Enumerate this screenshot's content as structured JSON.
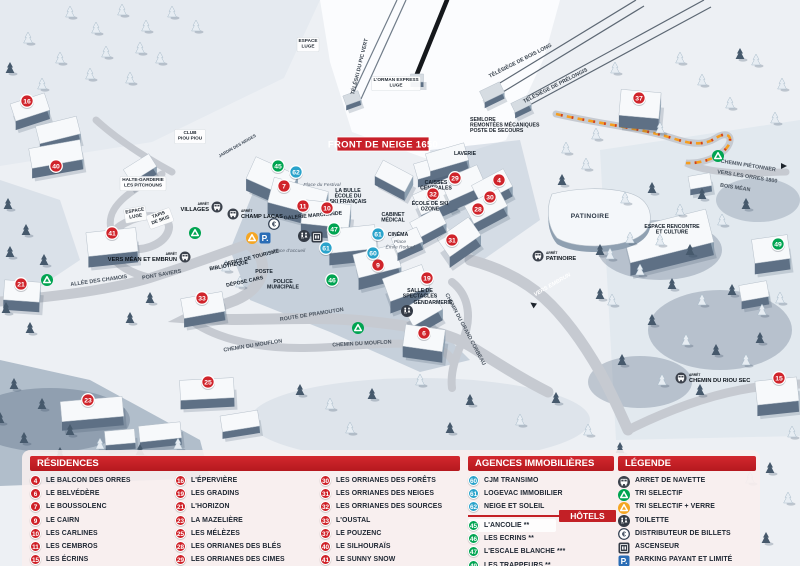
{
  "map": {
    "banner": "FRONT DE NEIGE 1650",
    "arret_word": "ARRÊT",
    "marker_colors": {
      "residence": "#d0242b",
      "hotel": "#00a451",
      "agency": "#2aa3cb"
    },
    "markers": [
      {
        "num": "16",
        "type": "residence",
        "x": 27,
        "y": 101
      },
      {
        "num": "40",
        "type": "residence",
        "x": 56,
        "y": 166
      },
      {
        "num": "41",
        "type": "residence",
        "x": 112,
        "y": 233
      },
      {
        "num": "21",
        "type": "residence",
        "x": 21,
        "y": 284
      },
      {
        "num": "33",
        "type": "residence",
        "x": 202,
        "y": 298
      },
      {
        "num": "23",
        "type": "residence",
        "x": 88,
        "y": 400
      },
      {
        "num": "25",
        "type": "residence",
        "x": 208,
        "y": 382
      },
      {
        "num": "7",
        "type": "residence",
        "x": 284,
        "y": 186
      },
      {
        "num": "11",
        "type": "residence",
        "x": 303,
        "y": 206
      },
      {
        "num": "10",
        "type": "residence",
        "x": 327,
        "y": 208
      },
      {
        "num": "9",
        "type": "residence",
        "x": 378,
        "y": 265
      },
      {
        "num": "19",
        "type": "residence",
        "x": 427,
        "y": 278
      },
      {
        "num": "6",
        "type": "residence",
        "x": 424,
        "y": 333
      },
      {
        "num": "32",
        "type": "residence",
        "x": 433,
        "y": 194
      },
      {
        "num": "29",
        "type": "residence",
        "x": 455,
        "y": 178
      },
      {
        "num": "4",
        "type": "residence",
        "x": 499,
        "y": 180
      },
      {
        "num": "30",
        "type": "residence",
        "x": 490,
        "y": 197
      },
      {
        "num": "28",
        "type": "residence",
        "x": 478,
        "y": 209
      },
      {
        "num": "31",
        "type": "residence",
        "x": 452,
        "y": 240
      },
      {
        "num": "37",
        "type": "residence",
        "x": 639,
        "y": 98
      },
      {
        "num": "15",
        "type": "residence",
        "x": 779,
        "y": 378
      },
      {
        "num": "45",
        "type": "hotel",
        "x": 278,
        "y": 166
      },
      {
        "num": "47",
        "type": "hotel",
        "x": 334,
        "y": 229
      },
      {
        "num": "46",
        "type": "hotel",
        "x": 332,
        "y": 280
      },
      {
        "num": "49",
        "type": "hotel",
        "x": 778,
        "y": 244
      },
      {
        "num": "62",
        "type": "agency",
        "x": 296,
        "y": 172
      },
      {
        "num": "61",
        "type": "agency",
        "x": 326,
        "y": 248
      },
      {
        "num": "61",
        "type": "agency",
        "x": 378,
        "y": 234
      },
      {
        "num": "60",
        "type": "agency",
        "x": 373,
        "y": 253
      }
    ],
    "labels": [
      {
        "text": "CLUB\nPIOU PIOU",
        "x": 190,
        "y": 134,
        "rot": 0,
        "cls": "wbox"
      },
      {
        "text": "ESPACE\nLUGE",
        "x": 308,
        "y": 42,
        "rot": 0,
        "cls": "wbox"
      },
      {
        "text": "L'ORMAN EXPRESS\nLUGE",
        "x": 396,
        "y": 81,
        "rot": 0,
        "cls": "wbox"
      },
      {
        "text": "HALTE-GARDERIE\nLES PITCHOUNS",
        "x": 143,
        "y": 181,
        "rot": 0,
        "cls": "wbox"
      },
      {
        "text": "ESPACE\nLUGE",
        "x": 135,
        "y": 212,
        "rot": -10,
        "cls": "wbox"
      },
      {
        "text": "TAPIS\nDE SKIS",
        "x": 159,
        "y": 216,
        "rot": -20,
        "cls": "wbox"
      },
      {
        "text": "JARDIN DES NEIGES",
        "x": 238,
        "y": 147,
        "rot": -30,
        "cls": "tiny"
      },
      {
        "text": "TÉLÉSKI DU PIC VERT",
        "x": 361,
        "y": 67,
        "rot": -76,
        "cls": "lift"
      },
      {
        "text": "TÉLÉSIÈGE DE BOIS LONG",
        "x": 521,
        "y": 62,
        "rot": -27,
        "cls": "lift"
      },
      {
        "text": "TÉLÉSIÈGE DE PRÉLONGIS",
        "x": 556,
        "y": 87,
        "rot": -27,
        "cls": "lift"
      },
      {
        "text": "SEMLORE\nREMONTÉES MÉCANIQUES\nPOSTE DE SECOURS",
        "x": 470,
        "y": 121,
        "rot": 0,
        "cls": "plainL"
      },
      {
        "text": "ALLÉE DES CHAMOIS",
        "x": 99,
        "y": 282,
        "rot": -8,
        "cls": "road"
      },
      {
        "text": "PONT SAVIERS",
        "x": 162,
        "y": 276,
        "rot": -10,
        "cls": "road"
      },
      {
        "text": "ROUTE DE PRAMOUTON",
        "x": 312,
        "y": 316,
        "rot": -9,
        "cls": "road"
      },
      {
        "text": "CHEMIN DU MOUFLON",
        "x": 253,
        "y": 347,
        "rot": -9,
        "cls": "road"
      },
      {
        "text": "CHEMIN DU MOUFLON",
        "x": 362,
        "y": 345,
        "rot": -3,
        "cls": "road"
      },
      {
        "text": "CHEMIN DU GRAND CORBEAU",
        "x": 464,
        "y": 330,
        "rot": 62,
        "cls": "road"
      },
      {
        "text": "VERS EMBRUN",
        "x": 553,
        "y": 286,
        "rot": -30,
        "cls": "roadlight"
      },
      {
        "text": "CHEMIN PIÉTONNIER",
        "x": 748,
        "y": 167,
        "rot": 9,
        "cls": "road"
      },
      {
        "text": "VERS LES ORRES 1800",
        "x": 747,
        "y": 178,
        "rot": 9,
        "cls": "road"
      },
      {
        "text": "BOIS MÉAN",
        "x": 735,
        "y": 189,
        "rot": 9,
        "cls": "road"
      },
      {
        "text": "OFFICE DE TOURISME",
        "x": 252,
        "y": 259,
        "rot": -14,
        "cls": "facility"
      },
      {
        "text": "BIBLIOTHÈQUE",
        "x": 229,
        "y": 267,
        "rot": -10,
        "cls": "facility"
      },
      {
        "text": "POSTE",
        "x": 264,
        "y": 273,
        "rot": 0,
        "cls": "facility"
      },
      {
        "text": "DÉPOSE CARS",
        "x": 245,
        "y": 283,
        "rot": -12,
        "cls": "facility"
      },
      {
        "text": "POLICE\nMUNICIPALE",
        "x": 283,
        "y": 283,
        "rot": 0,
        "cls": "facility"
      },
      {
        "text": "GALERIE MARCHANDE",
        "x": 313,
        "y": 217,
        "rot": -5,
        "cls": "facility"
      },
      {
        "text": "LA BULLE\nÉCOLE DU\nSKI FRANÇAIS",
        "x": 348,
        "y": 192,
        "rot": 0,
        "cls": "facility"
      },
      {
        "text": "CAISSES\nCENTRALES",
        "x": 436,
        "y": 184,
        "rot": 0,
        "cls": "facility"
      },
      {
        "text": "LAVERIE",
        "x": 465,
        "y": 155,
        "rot": 0,
        "cls": "facility"
      },
      {
        "text": "ÉCOLE DE SKI\nOZONE",
        "x": 430,
        "y": 205,
        "rot": 0,
        "cls": "facility"
      },
      {
        "text": "CABINET\nMÉDICAL",
        "x": 393,
        "y": 216,
        "rot": 0,
        "cls": "facility"
      },
      {
        "text": "CINÉMA",
        "x": 398,
        "y": 236,
        "rot": 0,
        "cls": "facility"
      },
      {
        "text": "SALLE DE\nSPECTACLES",
        "x": 420,
        "y": 292,
        "rot": 0,
        "cls": "facility"
      },
      {
        "text": "GENDARMERIE",
        "x": 433,
        "y": 304,
        "rot": 0,
        "cls": "facility"
      },
      {
        "text": "PATINOIRE",
        "x": 590,
        "y": 218,
        "rot": 0,
        "cls": "facility-lg"
      },
      {
        "text": "ESPACE RENCONTRE\nET CULTURE",
        "x": 672,
        "y": 228,
        "rot": 0,
        "cls": "facility"
      },
      {
        "text": "Place du Festival",
        "x": 322,
        "y": 186,
        "rot": 0,
        "cls": "pit"
      },
      {
        "text": "Place d'accueil",
        "x": 289,
        "y": 252,
        "rot": 0,
        "cls": "pit"
      },
      {
        "text": "Place\nÉmile Rodoul",
        "x": 400,
        "y": 243,
        "rot": 0,
        "cls": "pit"
      }
    ],
    "bus_stops": [
      {
        "name": "VILLAGES",
        "tx": 209,
        "ty": 211,
        "anchor": "end",
        "ix": 217,
        "iy": 207
      },
      {
        "name": "CHAMP LACAS",
        "tx": 241,
        "ty": 218,
        "anchor": "start",
        "ix": 233,
        "iy": 214
      },
      {
        "name": "VERS MÉAN ET EMBRUN",
        "tx": 177,
        "ty": 261,
        "anchor": "end",
        "ix": 185,
        "iy": 257
      },
      {
        "name": "PATINOIRE",
        "tx": 546,
        "ty": 260,
        "anchor": "start",
        "ix": 538,
        "iy": 256
      },
      {
        "name": "CHEMIN DU RIOU SEC",
        "tx": 689,
        "ty": 382,
        "anchor": "start",
        "ix": 681,
        "iy": 378
      }
    ],
    "icons": [
      {
        "type": "recycle-green",
        "x": 195,
        "y": 233
      },
      {
        "type": "recycle-green",
        "x": 47,
        "y": 280
      },
      {
        "type": "recycle-green",
        "x": 358,
        "y": 328
      },
      {
        "type": "recycle-green",
        "x": 718,
        "y": 156
      },
      {
        "type": "recycle-orange",
        "x": 252,
        "y": 238
      },
      {
        "type": "euro",
        "x": 274,
        "y": 224
      },
      {
        "type": "parking",
        "x": 265,
        "y": 238
      },
      {
        "type": "toilet",
        "x": 304,
        "y": 236
      },
      {
        "type": "toilet",
        "x": 407,
        "y": 311
      },
      {
        "type": "elevator",
        "x": 317,
        "y": 237
      },
      {
        "type": "arrow",
        "x": 533,
        "y": 297,
        "rot": 215
      },
      {
        "type": "arrow",
        "x": 788,
        "y": 172,
        "rot": 0
      }
    ]
  },
  "legend": {
    "residences": {
      "title": "RÉSIDENCES",
      "columns": [
        [
          {
            "num": "4",
            "label": "LE BALCON DES ORRES"
          },
          {
            "num": "6",
            "label": "LE BELVÉDÈRE"
          },
          {
            "num": "7",
            "label": "LE BOUSSOLENC"
          },
          {
            "num": "9",
            "label": "LE CAIRN"
          },
          {
            "num": "10",
            "label": "LES CARLINES"
          },
          {
            "num": "11",
            "label": "LES CEMBROS"
          },
          {
            "num": "15",
            "label": "LES ÉCRINS"
          }
        ],
        [
          {
            "num": "16",
            "label": "L'ÉPERVIÈRE"
          },
          {
            "num": "19",
            "label": "LES GRADINS"
          },
          {
            "num": "21",
            "label": "L'HORIZON"
          },
          {
            "num": "23",
            "label": "LA MAZELIÈRE"
          },
          {
            "num": "25",
            "label": "LES MÉLÈZES"
          },
          {
            "num": "28",
            "label": "LES ORRIANES DES BLÉS"
          },
          {
            "num": "29",
            "label": "LES ORRIANES DES CIMES"
          }
        ],
        [
          {
            "num": "30",
            "label": "LES ORRIANES DES FORÊTS"
          },
          {
            "num": "31",
            "label": "LES ORRIANES DES NEIGES"
          },
          {
            "num": "32",
            "label": "LES ORRIANES DES SOURCES"
          },
          {
            "num": "33",
            "label": "L'OUSTAL"
          },
          {
            "num": "37",
            "label": "LE POUZENC"
          },
          {
            "num": "40",
            "label": "LE SILHOURAÏS"
          },
          {
            "num": "41",
            "label": "LE SUNNY SNOW"
          }
        ]
      ]
    },
    "agencies": {
      "title": "AGENCES IMMOBILIÈRES",
      "items": [
        {
          "num": "60",
          "label": "CJM TRANSIMO"
        },
        {
          "num": "61",
          "label": "LOGEVAC IMMOBILIER"
        },
        {
          "num": "62",
          "label": "NEIGE ET SOLEIL"
        }
      ]
    },
    "hotels": {
      "title": "HÔTELS",
      "items": [
        {
          "num": "45",
          "label": "L'ANCOLIE **"
        },
        {
          "num": "46",
          "label": "LES ECRINS **"
        },
        {
          "num": "47",
          "label": "L'ESCALE BLANCHE ***"
        },
        {
          "num": "49",
          "label": "LES TRAPPEURS **"
        }
      ]
    },
    "legende": {
      "title": "LÉGENDE",
      "items": [
        {
          "icon": "bus",
          "label": "ARRET DE NAVETTE"
        },
        {
          "icon": "recycle-green",
          "label": "TRI SELECTIF"
        },
        {
          "icon": "recycle-orange",
          "label": "TRI SELECTIF + VERRE"
        },
        {
          "icon": "toilet",
          "label": "TOILETTE"
        },
        {
          "icon": "euro",
          "label": "DISTRIBUTEUR DE BILLETS"
        },
        {
          "icon": "elevator",
          "label": "ASCENSEUR"
        },
        {
          "icon": "parking",
          "label": "PARKING PAYANT ET LIMITÉ"
        }
      ]
    }
  }
}
